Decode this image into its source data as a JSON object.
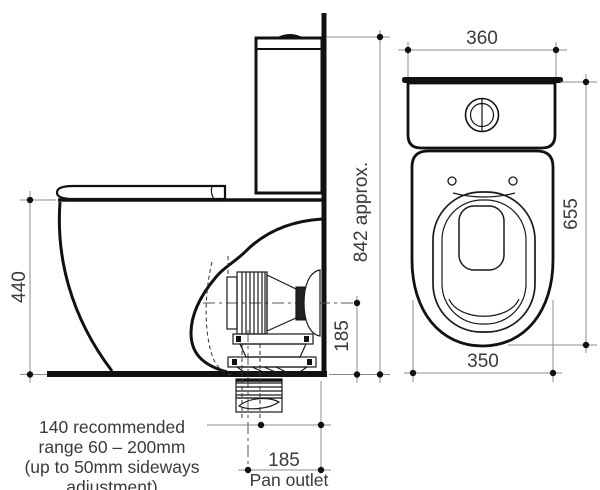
{
  "side_view": {
    "dim_seat_height": "440",
    "dim_overall_height": "842 approx.",
    "dim_outlet_height": "185",
    "dim_pan_outlet": "185",
    "pan_outlet_label": "Pan outlet",
    "note_lines": [
      "140 recommended",
      "range 60 – 200mm",
      "(up to 50mm sideways",
      "adjustment)"
    ]
  },
  "front_view": {
    "dim_width": "360",
    "dim_height": "655",
    "dim_bowl_width": "350"
  },
  "colors": {
    "line": "#111111",
    "dim_line": "#8c8c8c",
    "text": "#3a3a3a",
    "background": "#ffffff"
  }
}
